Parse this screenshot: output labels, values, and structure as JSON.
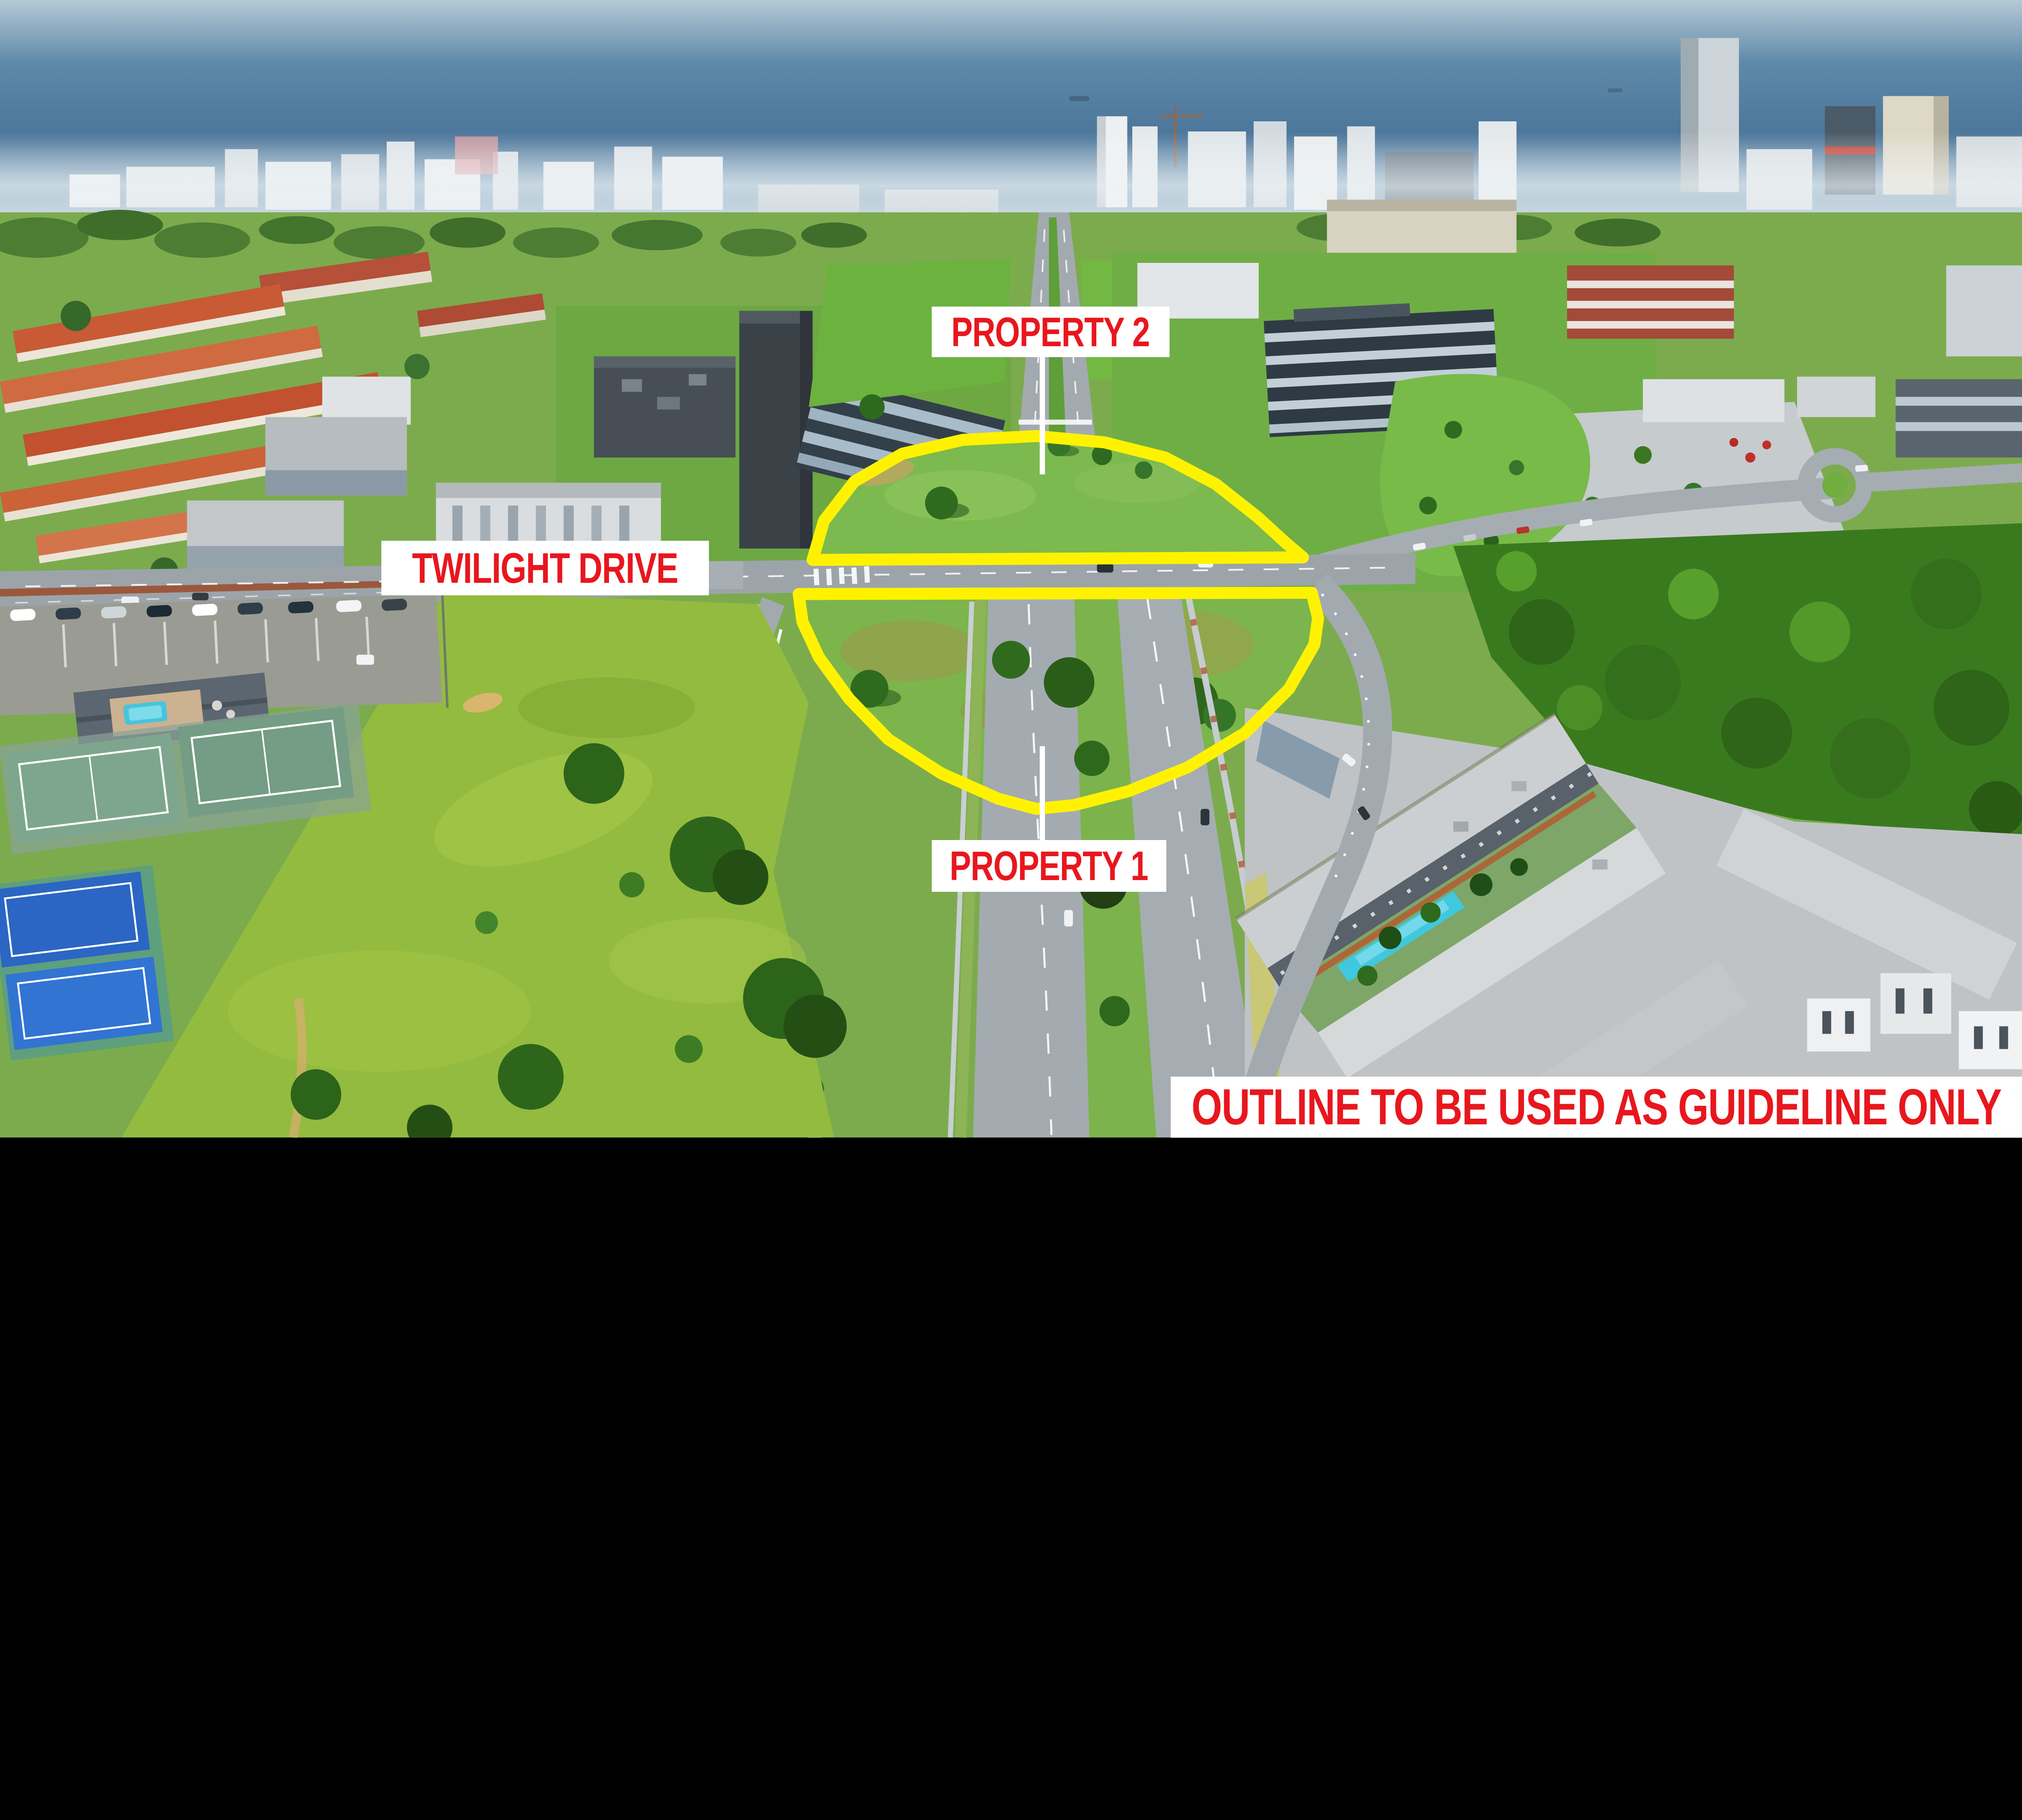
{
  "annotations": {
    "property2": "PROPERTY 2",
    "street": "TWILIGHT DRIVE",
    "property1": "PROPERTY 1",
    "disclaimer": "OUTLINE TO BE USED AS GUIDELINE ONLY"
  },
  "colors": {
    "label_text_red": "#e8171e",
    "label_bg": "#ffffff",
    "outline_yellow": "#fff200",
    "callout_white": "#ffffff"
  }
}
